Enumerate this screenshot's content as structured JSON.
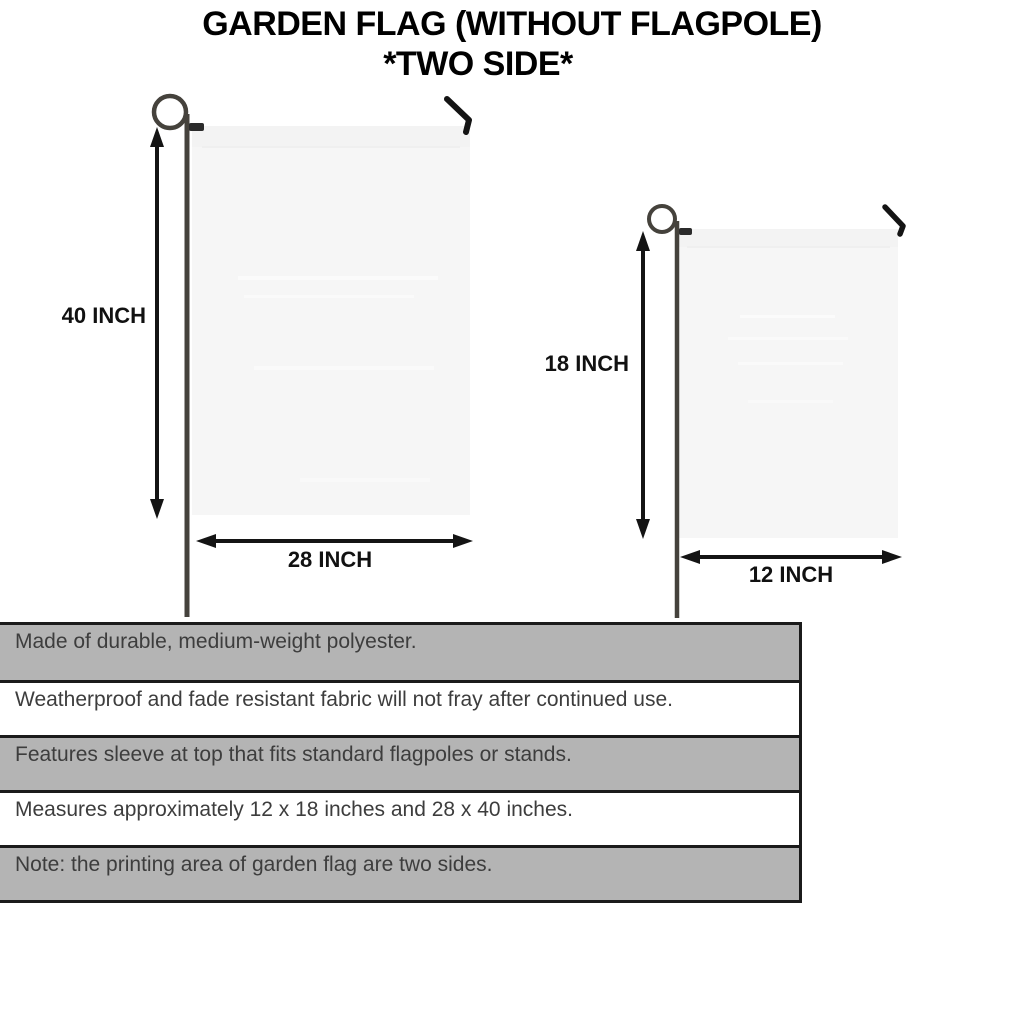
{
  "title": {
    "line1": "GARDEN FLAG (WITHOUT FLAGPOLE)",
    "line2": "*TWO SIDE*"
  },
  "diagram": {
    "large_flag": {
      "height_label": "40 INCH",
      "width_label": "28 INCH"
    },
    "small_flag": {
      "height_label": "18 INCH",
      "width_label": "12 INCH"
    }
  },
  "features": {
    "rows": [
      {
        "text": "Made of durable, medium-weight polyester."
      },
      {
        "text": "Weatherproof and fade resistant fabric will not fray after continued use."
      },
      {
        "text": "Features sleeve at top that fits standard flagpoles or stands."
      },
      {
        "text": "Measures approximately 12 x 18 inches and 28 x 40 inches."
      },
      {
        "text": "Note: the printing area of garden flag are two sides."
      }
    ]
  },
  "colors": {
    "title_text": "#000000",
    "dimension_text": "#111111",
    "table_row_shaded": "#b4b4b4",
    "table_row_plain": "#ffffff",
    "table_border": "#1b1b1b",
    "table_text": "#3d3d3d",
    "flag_fill": "#f6f6f6",
    "pole": "#45423c",
    "arrow_and_hook": "#141414"
  }
}
